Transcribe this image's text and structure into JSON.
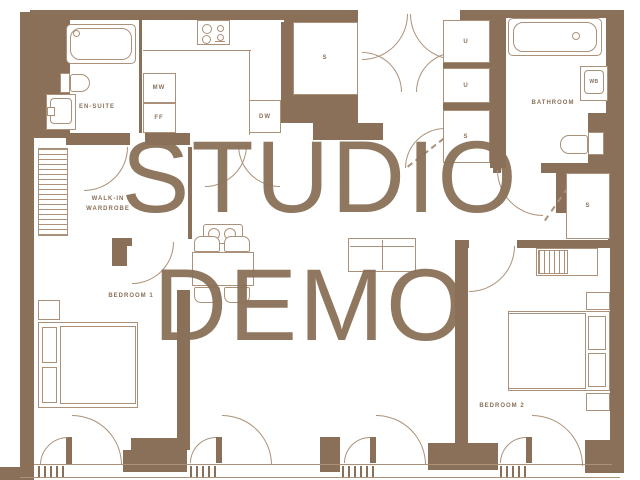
{
  "watermark": {
    "line1": "STUDIO",
    "line2": "DEMO"
  },
  "labels": {
    "ensuite": "EN-SUITE",
    "walk_in_line1": "WALK-IN",
    "walk_in_line2": "WARDROBE",
    "bedroom1": "BEDROOM 1",
    "bedroom2": "BEDROOM 2",
    "bathroom": "BATHROOM",
    "microwave": "MW",
    "fridge_freezer": "FF",
    "dishwasher": "DW",
    "wash_basin": "WB",
    "utility_1": "U",
    "utility_2": "U",
    "store_entry": "S",
    "store_hall": "S",
    "store_bedroom2": "S"
  },
  "colors": {
    "wall": "#8a7058",
    "fixture_line": "#ab9179",
    "background": "#ffffff",
    "watermark_text": "#8a7058"
  }
}
